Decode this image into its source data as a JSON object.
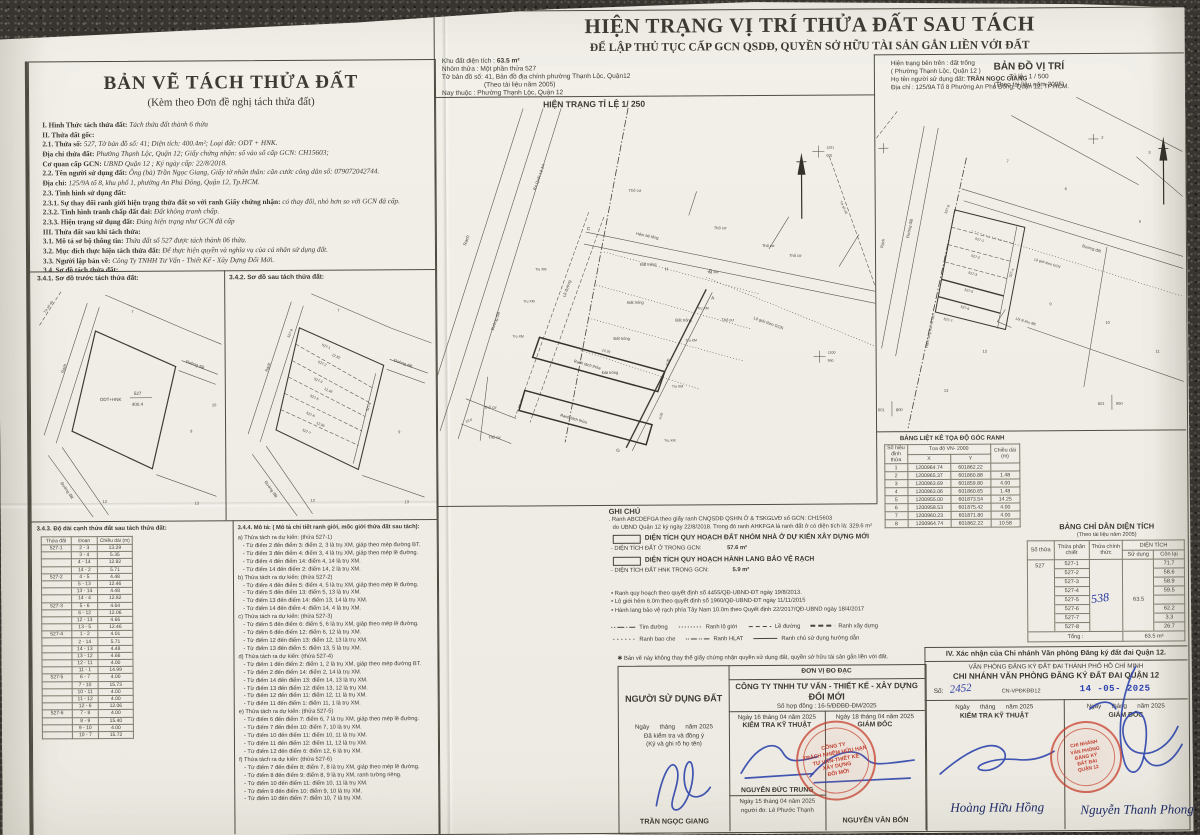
{
  "left_panel": {
    "title": "BẢN VẼ TÁCH THỬA ĐẤT",
    "subtitle": "(Kèm theo Đơn đề nghị tách thửa đất)",
    "lines": [
      {
        "c": "h",
        "label": "I. Hình Thức tách thửa đất: ",
        "value": "Tách thửa đất thành 6 thửa"
      },
      {
        "c": "h",
        "label": "II. Thửa đất gốc:",
        "value": ""
      },
      {
        "c": "n",
        "label": "2.1. Thửa số: ",
        "value": "527, Tờ bản đồ số: 41; Diện tích: 400.4m²; Loại đất: ODT + HNK."
      },
      {
        "c": "n",
        "label": "Địa chỉ thửa đất: ",
        "value": "Phường Thạnh Lộc, Quận 12; Giấy chứng nhận: số vào sổ cấp GCN: CH15603;"
      },
      {
        "c": "n",
        "label": "Cơ quan cấp GCN: ",
        "value": "UBND Quận 12 ; Ký ngày cấp: 22/8/2018."
      },
      {
        "c": "n",
        "label": "2.2. Tên người sử dụng đất: ",
        "value": "Ông (bà) Trần Ngọc Giang, Giấy tờ nhân thân: căn cước công dân số: 079072042744."
      },
      {
        "c": "n",
        "label": "Địa chỉ: ",
        "value": "125/9A tổ 8, khu phố 1, phường An Phú Đông, Quận 12, Tp.HCM."
      },
      {
        "c": "n",
        "label": "2.3. Tình hình sử dụng đất:",
        "value": ""
      },
      {
        "c": "n",
        "label": "2.3.1. Sự thay đổi ranh giới hiện trạng thửa đất so với ranh Giấy chứng nhận: ",
        "value": "có thay đổi, nhỏ hơn so với GCN đã cấp."
      },
      {
        "c": "n",
        "label": "2.3.2. Tình hình tranh chấp đất đai: ",
        "value": "Đất không tranh chấp."
      },
      {
        "c": "n",
        "label": "2.3.3. Hiện trạng sử dụng đất: ",
        "value": "Đúng hiện trạng như GCN đã cấp"
      },
      {
        "c": "h",
        "label": "III. Thửa đất sau khi tách thửa:",
        "value": ""
      },
      {
        "c": "n",
        "label": "3.1. Mô tả sơ bộ thông tin: ",
        "value": "Thửa đất số 527 được tách thành 06 thửa."
      },
      {
        "c": "n",
        "label": "3.2. Mục đích thực hiện tách thửa đất: ",
        "value": "Để thực hiện quyền và nghĩa vụ của cá nhân sử dụng đất."
      },
      {
        "c": "n",
        "label": "3.3. Người lập bản vẽ: ",
        "value": "Công Ty TNHH Tư Vấn - Thiết Kế - Xây Dựng Đổi Mới."
      },
      {
        "c": "h",
        "label": "3.4. Sơ đồ tách thửa đất:",
        "value": ""
      }
    ],
    "sketch_before_title": "3.4.1. Sơ đồ trước tách thửa đất:",
    "sketch_after_title": "3.4.2. Sơ đồ sau tách thửa đất:"
  },
  "sketch": {
    "rach": "Rạch",
    "duong_dat": "Đường đất",
    "to_so": "Tờ số 40",
    "parcel_num": "527",
    "parcel_area": "400.4",
    "land_type": "ODT+HNK",
    "d1": "12.82",
    "d2": "12.46",
    "d3": "12.06",
    "n7": "7",
    "n9": "9",
    "n10": "10",
    "n12": "12",
    "n13": "13",
    "p1": "527-1",
    "p2": "527-2",
    "p3": "527-3",
    "p4": "527-4",
    "p5": "527-5",
    "p6": "527-6",
    "p7": "527-7",
    "p8": "527-8"
  },
  "edge_table": {
    "title": "3.4.3. Độ dài cạnh thửa đất sau tách thửa đất:",
    "h1": "Thửa đất",
    "h2": "Đoạn",
    "h3": "Chiều dài (m)",
    "rows": [
      {
        "p": "527-1",
        "seg": "2 - 3",
        "len": "13.29"
      },
      {
        "p": "",
        "seg": "3 - 4",
        "len": "5.35"
      },
      {
        "p": "",
        "seg": "4 - 14",
        "len": "12.82"
      },
      {
        "p": "",
        "seg": "14 - 2",
        "len": "5.71"
      },
      {
        "p": "527-2",
        "seg": "4 - 5",
        "len": "4.48"
      },
      {
        "p": "",
        "seg": "5 - 13",
        "len": "12.46"
      },
      {
        "p": "",
        "seg": "13 - 14",
        "len": "4.48"
      },
      {
        "p": "",
        "seg": "14 - 4",
        "len": "12.82"
      },
      {
        "p": "527-3",
        "seg": "5 - 6",
        "len": "4.64"
      },
      {
        "p": "",
        "seg": "6 - 12",
        "len": "12.06"
      },
      {
        "p": "",
        "seg": "12 - 13",
        "len": "4.66"
      },
      {
        "p": "",
        "seg": "13 - 5",
        "len": "12.46"
      },
      {
        "p": "527-4",
        "seg": "1 - 2",
        "len": "4.01"
      },
      {
        "p": "",
        "seg": "2 - 14",
        "len": "5.71"
      },
      {
        "p": "",
        "seg": "14 - 13",
        "len": "4.48"
      },
      {
        "p": "",
        "seg": "13 - 12",
        "len": "4.66"
      },
      {
        "p": "",
        "seg": "12 - 11",
        "len": "4.00"
      },
      {
        "p": "",
        "seg": "11 - 1",
        "len": "14.99"
      },
      {
        "p": "527-5",
        "seg": "6 - 7",
        "len": "4.00"
      },
      {
        "p": "",
        "seg": "7 - 10",
        "len": "15.73"
      },
      {
        "p": "",
        "seg": "10 - 11",
        "len": "4.00"
      },
      {
        "p": "",
        "seg": "11 - 12",
        "len": "4.00"
      },
      {
        "p": "",
        "seg": "12 - 6",
        "len": "12.06"
      },
      {
        "p": "527-6",
        "seg": "7 - 8",
        "len": "4.00"
      },
      {
        "p": "",
        "seg": "8 - 9",
        "len": "15.40"
      },
      {
        "p": "",
        "seg": "9 - 10",
        "len": "4.00"
      },
      {
        "p": "",
        "seg": "10 - 7",
        "len": "15.72"
      }
    ]
  },
  "desc": {
    "title": "3.4.4. Mô tả: ( Mô tả chi tiết ranh giới, mốc giới thửa đất sau tách):",
    "lines": [
      {
        "c": "g",
        "t": "a) Thửa tách ra dự kiến: (thửa 527-1)"
      },
      {
        "c": "i",
        "t": "- Từ điểm 2 đến điểm 3: điểm 2, 3 là trụ XM, giáp theo mép đường BT."
      },
      {
        "c": "i",
        "t": "- Từ điểm 3 đến điểm 4: điểm 3, 4 là trụ XM, giáp theo mép lề đường."
      },
      {
        "c": "i",
        "t": "- Từ điểm 4 đến điểm 14: điểm 4, 14 là trụ XM."
      },
      {
        "c": "i",
        "t": "- Từ điểm 14 đến điểm 2: điểm 14, 2 là trụ XM."
      },
      {
        "c": "g",
        "t": "b) Thửa tách ra dự kiến: (thửa 527-2)"
      },
      {
        "c": "i",
        "t": "- Từ điểm 4 đến điểm 5: điểm 4, 5 là trụ XM, giáp theo mép lề đường."
      },
      {
        "c": "i",
        "t": "- Từ điểm 5 đến điểm 13: điểm 5, 13 là trụ XM."
      },
      {
        "c": "i",
        "t": "- Từ điểm 13 đến điểm 14: điểm 13, 14 là trụ XM."
      },
      {
        "c": "i",
        "t": "- Từ điểm 14 đến điểm 4: điểm 14, 4 là trụ XM."
      },
      {
        "c": "g",
        "t": "c) Thửa tách ra dự kiến: (thửa 527-3)"
      },
      {
        "c": "i",
        "t": "- Từ điểm 5 đến điểm 6: điểm 5, 6 là trụ XM, giáp theo mép lề đường."
      },
      {
        "c": "i",
        "t": "- Từ điểm 6 đến điểm 12: điểm 6, 12 là trụ XM."
      },
      {
        "c": "i",
        "t": "- Từ điểm 12 đến điểm 13: điểm 12, 13 là trụ XM."
      },
      {
        "c": "i",
        "t": "- Từ điểm 13 đến điểm 5: điểm 13, 5 là trụ XM."
      },
      {
        "c": "g",
        "t": "d) Thửa tách ra dự kiến: (thửa 527-4)"
      },
      {
        "c": "i",
        "t": "- Từ điểm 1 đến điểm 2: điểm 1, 2 là trụ XM, giáp theo mép đường BT."
      },
      {
        "c": "i",
        "t": "- Từ điểm 2 đến điểm 14: điểm 2, 14 là trụ XM."
      },
      {
        "c": "i",
        "t": "- Từ điểm 14 đến điểm 13: điểm 14, 13 là trụ XM."
      },
      {
        "c": "i",
        "t": "- Từ điểm 13 đến điểm 12: điểm 13, 12 là trụ XM."
      },
      {
        "c": "i",
        "t": "- Từ điểm 12 đến điểm 11: điểm 12, 11 là trụ XM."
      },
      {
        "c": "i",
        "t": "- Từ điểm 11 đến điểm 1: điểm 11, 1 là trụ XM."
      },
      {
        "c": "g",
        "t": "e) Thửa tách ra dự kiến: (thửa 527-5)"
      },
      {
        "c": "i",
        "t": "- Từ điểm 6 đến điểm 7: điểm 6, 7 là trụ XM, giáp theo mép lề đường."
      },
      {
        "c": "i",
        "t": "- Từ điểm 7 đến điểm 10: điểm 7, 10 là trụ XM."
      },
      {
        "c": "i",
        "t": "- Từ điểm 10 đến điểm 11: điểm 10, 11 là trụ XM."
      },
      {
        "c": "i",
        "t": "- Từ điểm 11 đến điểm 12: điểm 11, 12 là trụ XM."
      },
      {
        "c": "i",
        "t": "- Từ điểm 12 đến điểm 6: điểm 12, 6 là trụ XM."
      },
      {
        "c": "g",
        "t": "f) Thửa tách ra dự kiến: (thửa 527-6)"
      },
      {
        "c": "i",
        "t": "- Từ điểm 7 đến điểm 8: điểm 7, 8 là trụ XM, giáp theo mép lề đường."
      },
      {
        "c": "i",
        "t": "- Từ điểm 8 đến điểm 9: điểm 8, 9 là trụ XM, ranh tường riêng."
      },
      {
        "c": "i",
        "t": "- Từ điểm 10 đến điểm 11: điểm 10, 11 là trụ XM."
      },
      {
        "c": "i",
        "t": "- Từ điểm 9 đến điểm 10: điểm 9, 10 là trụ XM."
      },
      {
        "c": "i",
        "t": "- Từ điểm 10 đến điểm 7: điểm 10, 7 là trụ XM."
      }
    ]
  },
  "header": {
    "title": "HIỆN TRẠNG VỊ TRÍ THỬA ĐẤT SAU TÁCH",
    "subtitle": "ĐỂ LẬP THỦ TỤC CẤP GCN QSDĐ, QUYỀN SỞ HỮU TÀI SẢN GẮN LIỀN VỚI ĐẤT"
  },
  "info_left": {
    "area_label": "Khu đất diện tích :",
    "area_value": "63.5 m²",
    "l2": "Nhóm thửa : Một phần thửa 527",
    "l3": "Tờ bản đồ số: 41, Bản đồ địa chính phường Thạnh Lộc, Quận12",
    "l4": "(Theo tài liệu năm 2005)",
    "l5": "Nay thuộc : Phường Thạnh Lộc, Quận 12"
  },
  "info_right": {
    "l1": "Hiện trạng bên trên : đất trống",
    "l2": "( Phường Thạnh Lộc, Quận 12 )",
    "l3_label": "Họ tên người sử dụng đất: ",
    "l3_value": "TRẦN NGỌC GIANG",
    "l4": "Địa chỉ : 125/9A Tổ 8 Phường An Phú Đông, Quận 12, TP.HCM."
  },
  "map_main": {
    "caption": "HIỆN TRẠNG TỈ LỆ 1/ 250",
    "labels": {
      "rach": "Rạch",
      "ra_ql": "Ra Quốc Lộ 1A",
      "le_duong": "Lề đường",
      "duong_dat": "Đường đất",
      "hem": "Hẻm bê tông",
      "tho_cu": "Thổ cư",
      "dat_trong": "Đất trống",
      "tru_xm": "Trụ XM",
      "lo_gioi": "Lộ giới theo GCN",
      "ranh": "Ranh tách thửa",
      "to_so": "Tờ số 40",
      "grid1a": "1201",
      "grid1b": "000",
      "grid2a": "1200",
      "grid2b": "950",
      "d1": "14.25",
      "d2": "4.00",
      "d3": "10.0",
      "pA": "A",
      "pB": "B",
      "pC": "C",
      "pG": "G",
      "pH": "H"
    }
  },
  "map_loc": {
    "title": "BẢN ĐỒ VỊ TRÍ",
    "scale": "Tỷ lệ : 1 / 500",
    "source": "(Theo tài liệu năm 2005)",
    "labels": {
      "rach": "Rạch",
      "duong_dat": "Đường đất",
      "lo_gioi": "Lộ giới theo GCN",
      "hlbv": "Hành lang bảo vệ rạch",
      "loi_di": "Lối đi khu đất",
      "c1a": "601",
      "c1b": "800",
      "c2a": "601",
      "c2b": "900",
      "n2": "2",
      "n3": "3",
      "n5": "5",
      "n6": "6",
      "n7": "7",
      "n9": "9",
      "n10": "10",
      "n11": "11",
      "n12": "12",
      "n13": "13"
    }
  },
  "notes": {
    "title": "GHI CHÚ",
    "line1": ". Ranh ABCDEFGA theo giấy ranh CNQSDĐ QSHN Ở & TSKGLVĐ số GCN: CH15603",
    "line2": "do UBND Quận 12 ký ngày 22/8/2018. Trong đó ranh AHKFGA là ranh đất ở có diện tích là: 329.6 m²",
    "box1": "DIỆN TÍCH QUY HOẠCH ĐẤT NHÓM NHÀ Ở DỰ KIẾN XÂY DỰNG MỚI",
    "box1_label": "- DIỆN TÍCH ĐẤT Ở TRONG GCN:",
    "box1_value": "57.6 m²",
    "box2": "DIỆN TÍCH QUY HOẠCH HÀNH LANG BẢO VỆ RẠCH",
    "box2_label": "- DIỆN TÍCH ĐẤT HNK TRONG GCN:",
    "box2_value": "5.9 m²",
    "bullets": [
      "Ranh quy hoạch theo quyết định số 4455/QĐ-UBND-ĐT ngày 19/8/2013.",
      "Lộ giới hẻm 6.0m theo quyết định số 1960/QĐ-UBND-ĐT ngày 11/11/2015",
      "Hành lang bảo vệ rạch phía Tây Nam 10.0m theo Quyết định 22/2017/QĐ-UBND ngày 18/4/2017"
    ],
    "legend": [
      {
        "c": "dashdot",
        "label": "Tim đường"
      },
      {
        "c": "dotted",
        "label": "Ranh lộ giới"
      },
      {
        "c": "dashed",
        "label": "Lề đường"
      },
      {
        "c": "dashed2",
        "label": "Ranh xây dựng"
      },
      {
        "c": "dotted2",
        "label": "Ranh bao che"
      },
      {
        "c": "dashdot2",
        "label": "Ranh HLAT"
      },
      {
        "c": "solid",
        "label": "Ranh chủ sử dụng hướng dẫn"
      }
    ],
    "disclaimer": "✱ Bản vẽ này không thay thế giấy chứng nhận quyền sử dụng đất, quyền sở hữu tài sản gắn liền với đất."
  },
  "coord_table": {
    "title": "BẢNG LIỆT KÊ TỌA ĐỘ GÓC RANH",
    "col_point": "Số hiệu đỉnh thửa",
    "col_coord": "Tọa độ VN- 2000",
    "col_x": "X",
    "col_y": "Y",
    "col_len": "Chiều dài (m)",
    "rows": [
      {
        "n": "1",
        "x": "1200964.74",
        "y": "601862.22",
        "len": ""
      },
      {
        "n": "2",
        "x": "1200965.37",
        "y": "601860.88",
        "len": "1.48"
      },
      {
        "n": "3",
        "x": "1200963.69",
        "y": "601859.80",
        "len": "4.00"
      },
      {
        "n": "4",
        "x": "1200963.06",
        "y": "601860.65",
        "len": "1.48"
      },
      {
        "n": "5",
        "x": "1200955.00",
        "y": "601873.54",
        "len": "14.25"
      },
      {
        "n": "6",
        "x": "1200958.53",
        "y": "601875.42",
        "len": "4.00"
      },
      {
        "n": "7",
        "x": "1200960.23",
        "y": "601871.80",
        "len": "4.00"
      },
      {
        "n": "8",
        "x": "1200964.74",
        "y": "601862.22",
        "len": "10.58"
      }
    ]
  },
  "area_table": {
    "title": "BẢNG CHỈ DẪN DIỆN TÍCH",
    "subtitle": "(Theo tài liệu năm 2005)",
    "col_so": "Số thửa",
    "col_chiet": "Thửa phân chiết",
    "col_chinh": "Thửa chính thức",
    "col_dt": "DIỆN TÍCH",
    "col_sd": "Sử dụng",
    "col_cl": "Còn lại",
    "parcel": "527",
    "official_hand": "538",
    "use_value": "63.5",
    "rows": [
      {
        "sub": "527-1",
        "remain": "71.7"
      },
      {
        "sub": "527-2",
        "remain": "58.6"
      },
      {
        "sub": "527-3",
        "remain": "58.9"
      },
      {
        "sub": "527-4",
        "remain": "59.5"
      },
      {
        "sub": "527-5",
        "remain": ""
      },
      {
        "sub": "527-6",
        "remain": "62.2"
      },
      {
        "sub": "527-7",
        "remain": "3.3"
      },
      {
        "sub": "527-8",
        "remain": "26.7"
      }
    ],
    "total_label": "Tổng :",
    "total_value": "63.5 m²"
  },
  "band": {
    "note": "✱ Bản vẽ này không thay thế giấy chứng nhận quyền sử dụng đất, quyền sở hữu tài sản gắn liền với đất.",
    "user": {
      "title": "NGƯỜI SỬ DỤNG ĐẤT",
      "date": "Ngày      tháng      năm 2025",
      "l1": "Đã kiểm tra và đồng ý",
      "l2": "(Ký và ghi rõ họ tên)",
      "name": "TRẦN NGỌC GIANG"
    },
    "unit": {
      "header": "ĐƠN VỊ ĐO ĐẠC",
      "company": "CÔNG TY TNHH TƯ VẤN  - THIẾT KẾ - XÂY DỰNG",
      "company2": "ĐỔI MỚI",
      "contract": "Số hợp đồng : 16-5/ĐĐBĐ-ĐM/2025",
      "tech_date": "Ngày 16 tháng 04 năm 2025",
      "tech_role": "KIỂM TRA KỸ THUẬT",
      "tech_name": "NGUYỄN ĐỨC TRUNG",
      "survey_date": "Ngày 15 tháng 04 năm 2025",
      "surveyor": "người đo: Lê Phước Thạnh",
      "dir_date": "Ngày 18 tháng 04 năm 2025",
      "dir_role": "GIÁM ĐỐC",
      "dir_name": "NGUYỄN VĂN BỐN"
    },
    "office": {
      "section": "IV. Xác nhận của Chi nhánh Văn phòng Đăng ký đất đai Quận 12.",
      "org1": "VĂN PHÒNG ĐĂNG KÝ ĐẤT ĐAI THÀNH PHỐ HỒ CHÍ MINH",
      "org2": "CHI NHÁNH VĂN PHÒNG ĐĂNG KÝ ĐẤT ĐAI QUẬN 12",
      "so_label": "Số:",
      "so_value": "2452",
      "code": "CN-VPĐKĐĐ12",
      "date_stamp": "14 -05- 2025",
      "tech_date": "Ngày      tháng      năm 2025",
      "tech_role": "KIỂM TRA KỸ THUẬT",
      "tech_sign": "Hoàng Hữu Hồng",
      "dir_date": "Ngày      tháng      năm 2025",
      "dir_role": "GIÁM ĐỐC",
      "dir_sign": "Nguyễn Thanh Phong"
    }
  },
  "stamps": {
    "company": [
      "CÔNG TY",
      "TRÁCH NHIỆM HỮU HẠN",
      "TƯ VẤN-THIẾT KẾ",
      "XÂY DỰNG",
      "ĐỔI MỚI"
    ],
    "office": [
      "CHI NHÁNH",
      "VĂN PHÒNG",
      "ĐĂNG KÝ",
      "ĐẤT ĐAI",
      "QUẬN 12"
    ]
  }
}
